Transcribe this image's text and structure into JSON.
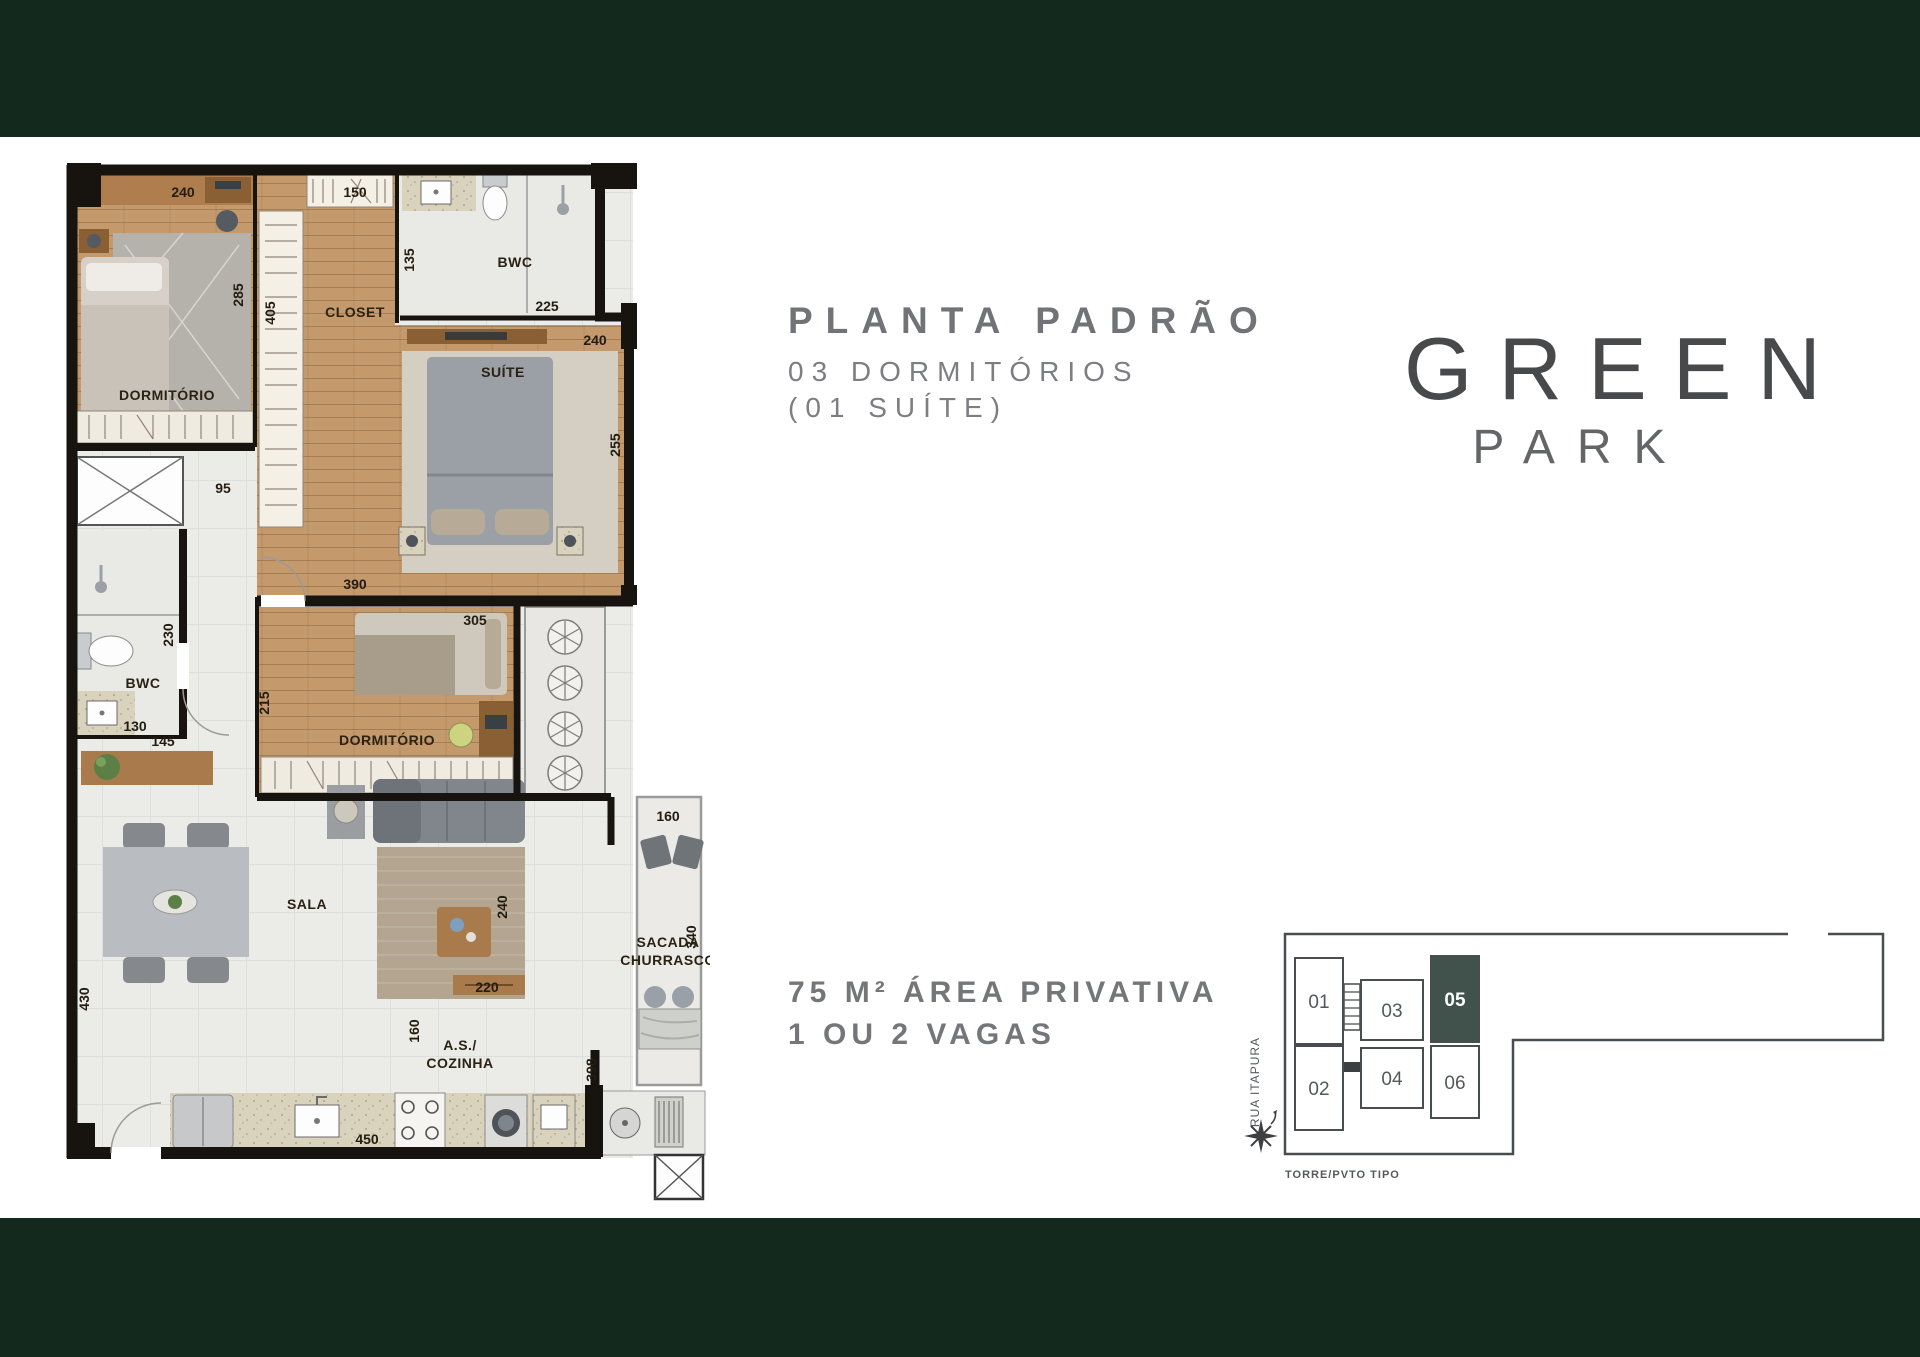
{
  "page": {
    "band_color": "#13291d",
    "background": "#ffffff"
  },
  "title_block": {
    "title": "PLANTA PADRÃO",
    "subtitle_line1": "03 DORMITÓRIOS",
    "subtitle_line2": "(01 SUÍTE)"
  },
  "logo": {
    "line1": "GREEN",
    "line2": "PARK"
  },
  "area_block": {
    "line1": "75 M² ÁREA PRIVATIVA",
    "line2": "1 OU 2 VAGAS"
  },
  "floorplan": {
    "texts": [
      {
        "t": "240",
        "x": 128,
        "y": 52,
        "k": "dim"
      },
      {
        "t": "285",
        "x": 188,
        "y": 150,
        "r": -90,
        "k": "dim"
      },
      {
        "t": "DORMITÓRIO",
        "x": 112,
        "y": 255,
        "k": "room"
      },
      {
        "t": "150",
        "x": 300,
        "y": 52,
        "k": "dim"
      },
      {
        "t": "405",
        "x": 220,
        "y": 168,
        "r": -90,
        "k": "dim"
      },
      {
        "t": "CLOSET",
        "x": 300,
        "y": 172,
        "k": "room"
      },
      {
        "t": "135",
        "x": 359,
        "y": 115,
        "r": -90,
        "k": "dim"
      },
      {
        "t": "BWC",
        "x": 460,
        "y": 122,
        "k": "room"
      },
      {
        "t": "225",
        "x": 492,
        "y": 166,
        "k": "dim"
      },
      {
        "t": "240",
        "x": 540,
        "y": 200,
        "k": "dim"
      },
      {
        "t": "SUÍTE",
        "x": 448,
        "y": 232,
        "k": "room"
      },
      {
        "t": "255",
        "x": 565,
        "y": 300,
        "r": -90,
        "k": "dim"
      },
      {
        "t": "390",
        "x": 300,
        "y": 444,
        "k": "dim"
      },
      {
        "t": "305",
        "x": 420,
        "y": 480,
        "k": "dim"
      },
      {
        "t": "95",
        "x": 168,
        "y": 348,
        "k": "dim"
      },
      {
        "t": "230",
        "x": 118,
        "y": 490,
        "r": -90,
        "k": "dim"
      },
      {
        "t": "BWC",
        "x": 88,
        "y": 543,
        "k": "room"
      },
      {
        "t": "130",
        "x": 80,
        "y": 586,
        "k": "dim"
      },
      {
        "t": "145",
        "x": 108,
        "y": 601,
        "k": "dim"
      },
      {
        "t": "215",
        "x": 214,
        "y": 558,
        "r": -90,
        "k": "dim"
      },
      {
        "t": "DORMITÓRIO",
        "x": 332,
        "y": 600,
        "k": "room"
      },
      {
        "t": "SALA",
        "x": 252,
        "y": 764,
        "k": "room"
      },
      {
        "t": "430",
        "x": 34,
        "y": 854,
        "r": -90,
        "k": "dim"
      },
      {
        "t": "240",
        "x": 452,
        "y": 762,
        "r": -90,
        "k": "dim"
      },
      {
        "t": "220",
        "x": 432,
        "y": 847,
        "k": "dim"
      },
      {
        "t": "160",
        "x": 364,
        "y": 886,
        "r": -90,
        "k": "dim"
      },
      {
        "t": "160",
        "x": 613,
        "y": 676,
        "k": "dim"
      },
      {
        "t": "340",
        "x": 641,
        "y": 792,
        "r": -90,
        "k": "dim"
      },
      {
        "t": "SACADA",
        "x": 613,
        "y": 802,
        "k": "room"
      },
      {
        "t": "CHURRASCO",
        "x": 613,
        "y": 820,
        "k": "room"
      },
      {
        "t": "A.S./",
        "x": 405,
        "y": 905,
        "k": "room"
      },
      {
        "t": "COZINHA",
        "x": 405,
        "y": 923,
        "k": "room"
      },
      {
        "t": "450",
        "x": 312,
        "y": 999,
        "k": "dim"
      },
      {
        "t": "398",
        "x": 541,
        "y": 925,
        "r": -90,
        "k": "dim"
      }
    ]
  },
  "keyplan": {
    "street": "RUA ITAPURA",
    "caption": "TORRE/PVTO TIPO",
    "outline_color": "#484d50",
    "highlight_color": "#41514b",
    "units": [
      {
        "number": "01",
        "x": 52,
        "y": 36,
        "w": 48,
        "h": 86,
        "highlighted": false
      },
      {
        "number": "02",
        "x": 52,
        "y": 124,
        "w": 48,
        "h": 84,
        "highlighted": false
      },
      {
        "number": "03",
        "x": 118,
        "y": 58,
        "w": 62,
        "h": 60,
        "highlighted": false
      },
      {
        "number": "04",
        "x": 118,
        "y": 126,
        "w": 62,
        "h": 60,
        "highlighted": false
      },
      {
        "number": "05",
        "x": 188,
        "y": 34,
        "w": 48,
        "h": 86,
        "highlighted": true
      },
      {
        "number": "06",
        "x": 188,
        "y": 124,
        "w": 48,
        "h": 72,
        "highlighted": false
      }
    ]
  }
}
